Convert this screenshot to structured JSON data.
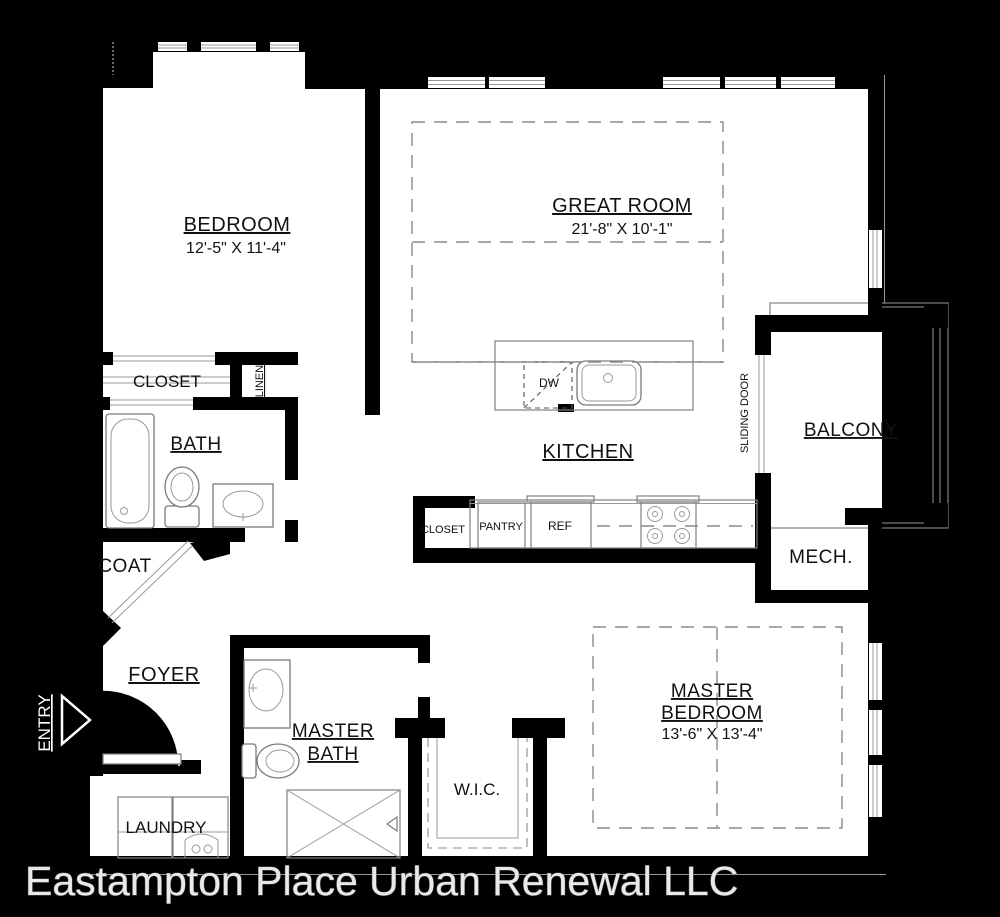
{
  "footer": {
    "company": "Eastampton Place Urban Renewal LLC"
  },
  "colors": {
    "background": "#000000",
    "walls": "#000000",
    "floor": "#ffffff",
    "linework": "#808080",
    "label_text": "#111111",
    "footer_text": "#e9e9e9"
  },
  "labels": {
    "bedroom": "BEDROOM",
    "bedroom_dims": "12'-5\" X 11'-4\"",
    "great_room": "GREAT ROOM",
    "great_room_dims": "21'-8\" X 10'-1\"",
    "kitchen": "KITCHEN",
    "closet": "CLOSET",
    "linen": "LINEN",
    "bath": "BATH",
    "coat": "COAT",
    "foyer": "FOYER",
    "entry": "ENTRY",
    "laundry": "LAUNDRY",
    "master_bath_line1": "MASTER",
    "master_bath_line2": "BATH",
    "wic": "W.I.C.",
    "master_bedroom_line1": "MASTER",
    "master_bedroom_line2": "BEDROOM",
    "master_bedroom_dims": "13'-6\" X 13'-4\"",
    "balcony": "BALCONY",
    "mech": "MECH.",
    "sliding_door": "SLIDING DOOR",
    "dw": "DW",
    "closet_kitchen": "CLOSET",
    "pantry": "PANTRY",
    "ref": "REF"
  }
}
